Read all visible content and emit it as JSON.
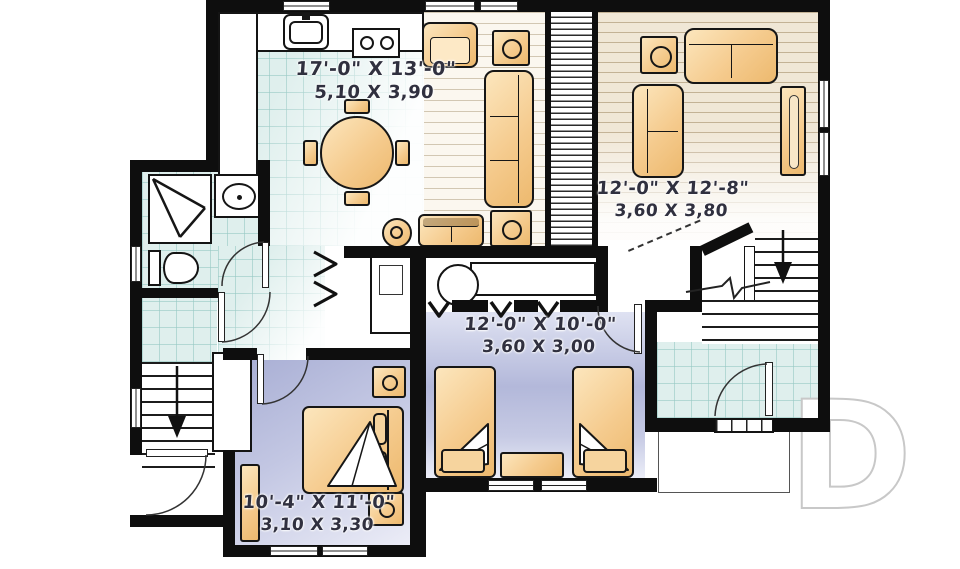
{
  "plan": {
    "rooms": [
      {
        "name": "kitchen-dining-living",
        "imperial": "17'-0\" X 13'-0\"",
        "metric": "5,10 X 3,90"
      },
      {
        "name": "living-room",
        "imperial": "12'-0\" X 12'-8\"",
        "metric": "3,60 X 3,80"
      },
      {
        "name": "bedroom-2",
        "imperial": "12'-0\" X 10'-0\"",
        "metric": "3,60 X 3,00"
      },
      {
        "name": "bedroom-1",
        "imperial": "10'-4\" X 11'-0\"",
        "metric": "3,10 X 3,30"
      }
    ],
    "watermark_letter": "D",
    "colors": {
      "wall": "#0e0e0e",
      "furniture": "#f2c98c",
      "tile": "#dfefed",
      "carpet": "#b7bcdc",
      "wood": "#f3ecdf"
    }
  }
}
